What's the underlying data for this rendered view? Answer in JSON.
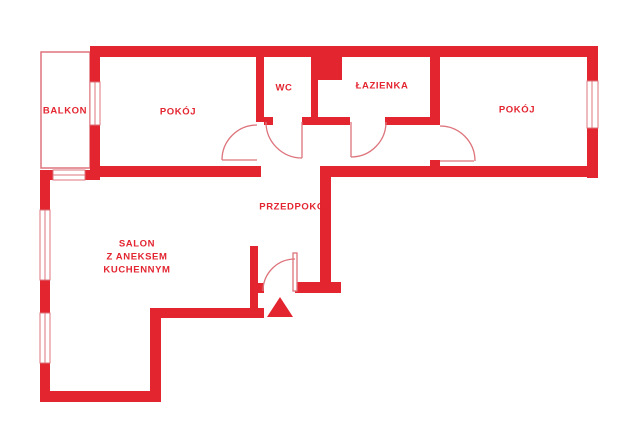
{
  "colors": {
    "wall": "#e32530",
    "thin": "#dd747c",
    "label": "#e32530",
    "background": "#ffffff"
  },
  "floorplan": {
    "rooms": {
      "balkon": "BALKON",
      "pokoj1": "POKÓJ",
      "wc": "WC",
      "lazienka": "ŁAZIENKA",
      "pokoj2": "POKÓJ",
      "przedpokoj": "PRZEDPOKÓJ",
      "salon_line1": "SALON",
      "salon_line2": "Z ANEKSEM",
      "salon_line3": "KUCHENNYM"
    }
  }
}
